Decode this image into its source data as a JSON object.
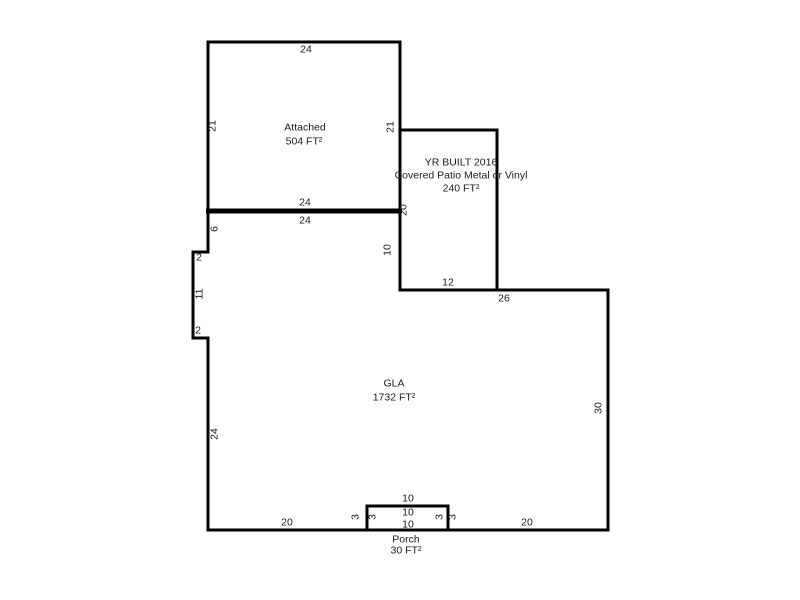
{
  "sketch": {
    "background_color": "#ffffff",
    "wall_color": "#000000",
    "areas": {
      "garage": {
        "name": "Attached",
        "area": "504 FT²"
      },
      "patio": {
        "year_line": "YR BUILT 2016",
        "desc_line": "Covered Patio Metal or Vinyl",
        "area": "240 FT²"
      },
      "gla": {
        "name": "GLA",
        "area": "1732 FT²"
      },
      "porch": {
        "name": "Porch",
        "area": "30 FT²"
      }
    },
    "dimensions": {
      "garage_top": "24",
      "garage_left": "21",
      "garage_right": "21",
      "garage_bottom": "24",
      "gla_top": "24",
      "gla_left_upper": "6",
      "jog_top": "2",
      "jog_middle": "11",
      "jog_bottom": "2",
      "gla_left_lower": "24",
      "patio_left": "20",
      "gla_right_upper": "10",
      "patio_bottom": "12",
      "gla_top_right": "26",
      "gla_right": "30",
      "gla_bottom_left": "20",
      "gla_bottom_right": "20",
      "porch_top": "10",
      "porch_mid": "10",
      "porch_bottom": "10",
      "porch_left_outer": "3",
      "porch_left_inner": "3",
      "porch_right_inner": "3",
      "porch_right_outer": "3"
    }
  }
}
